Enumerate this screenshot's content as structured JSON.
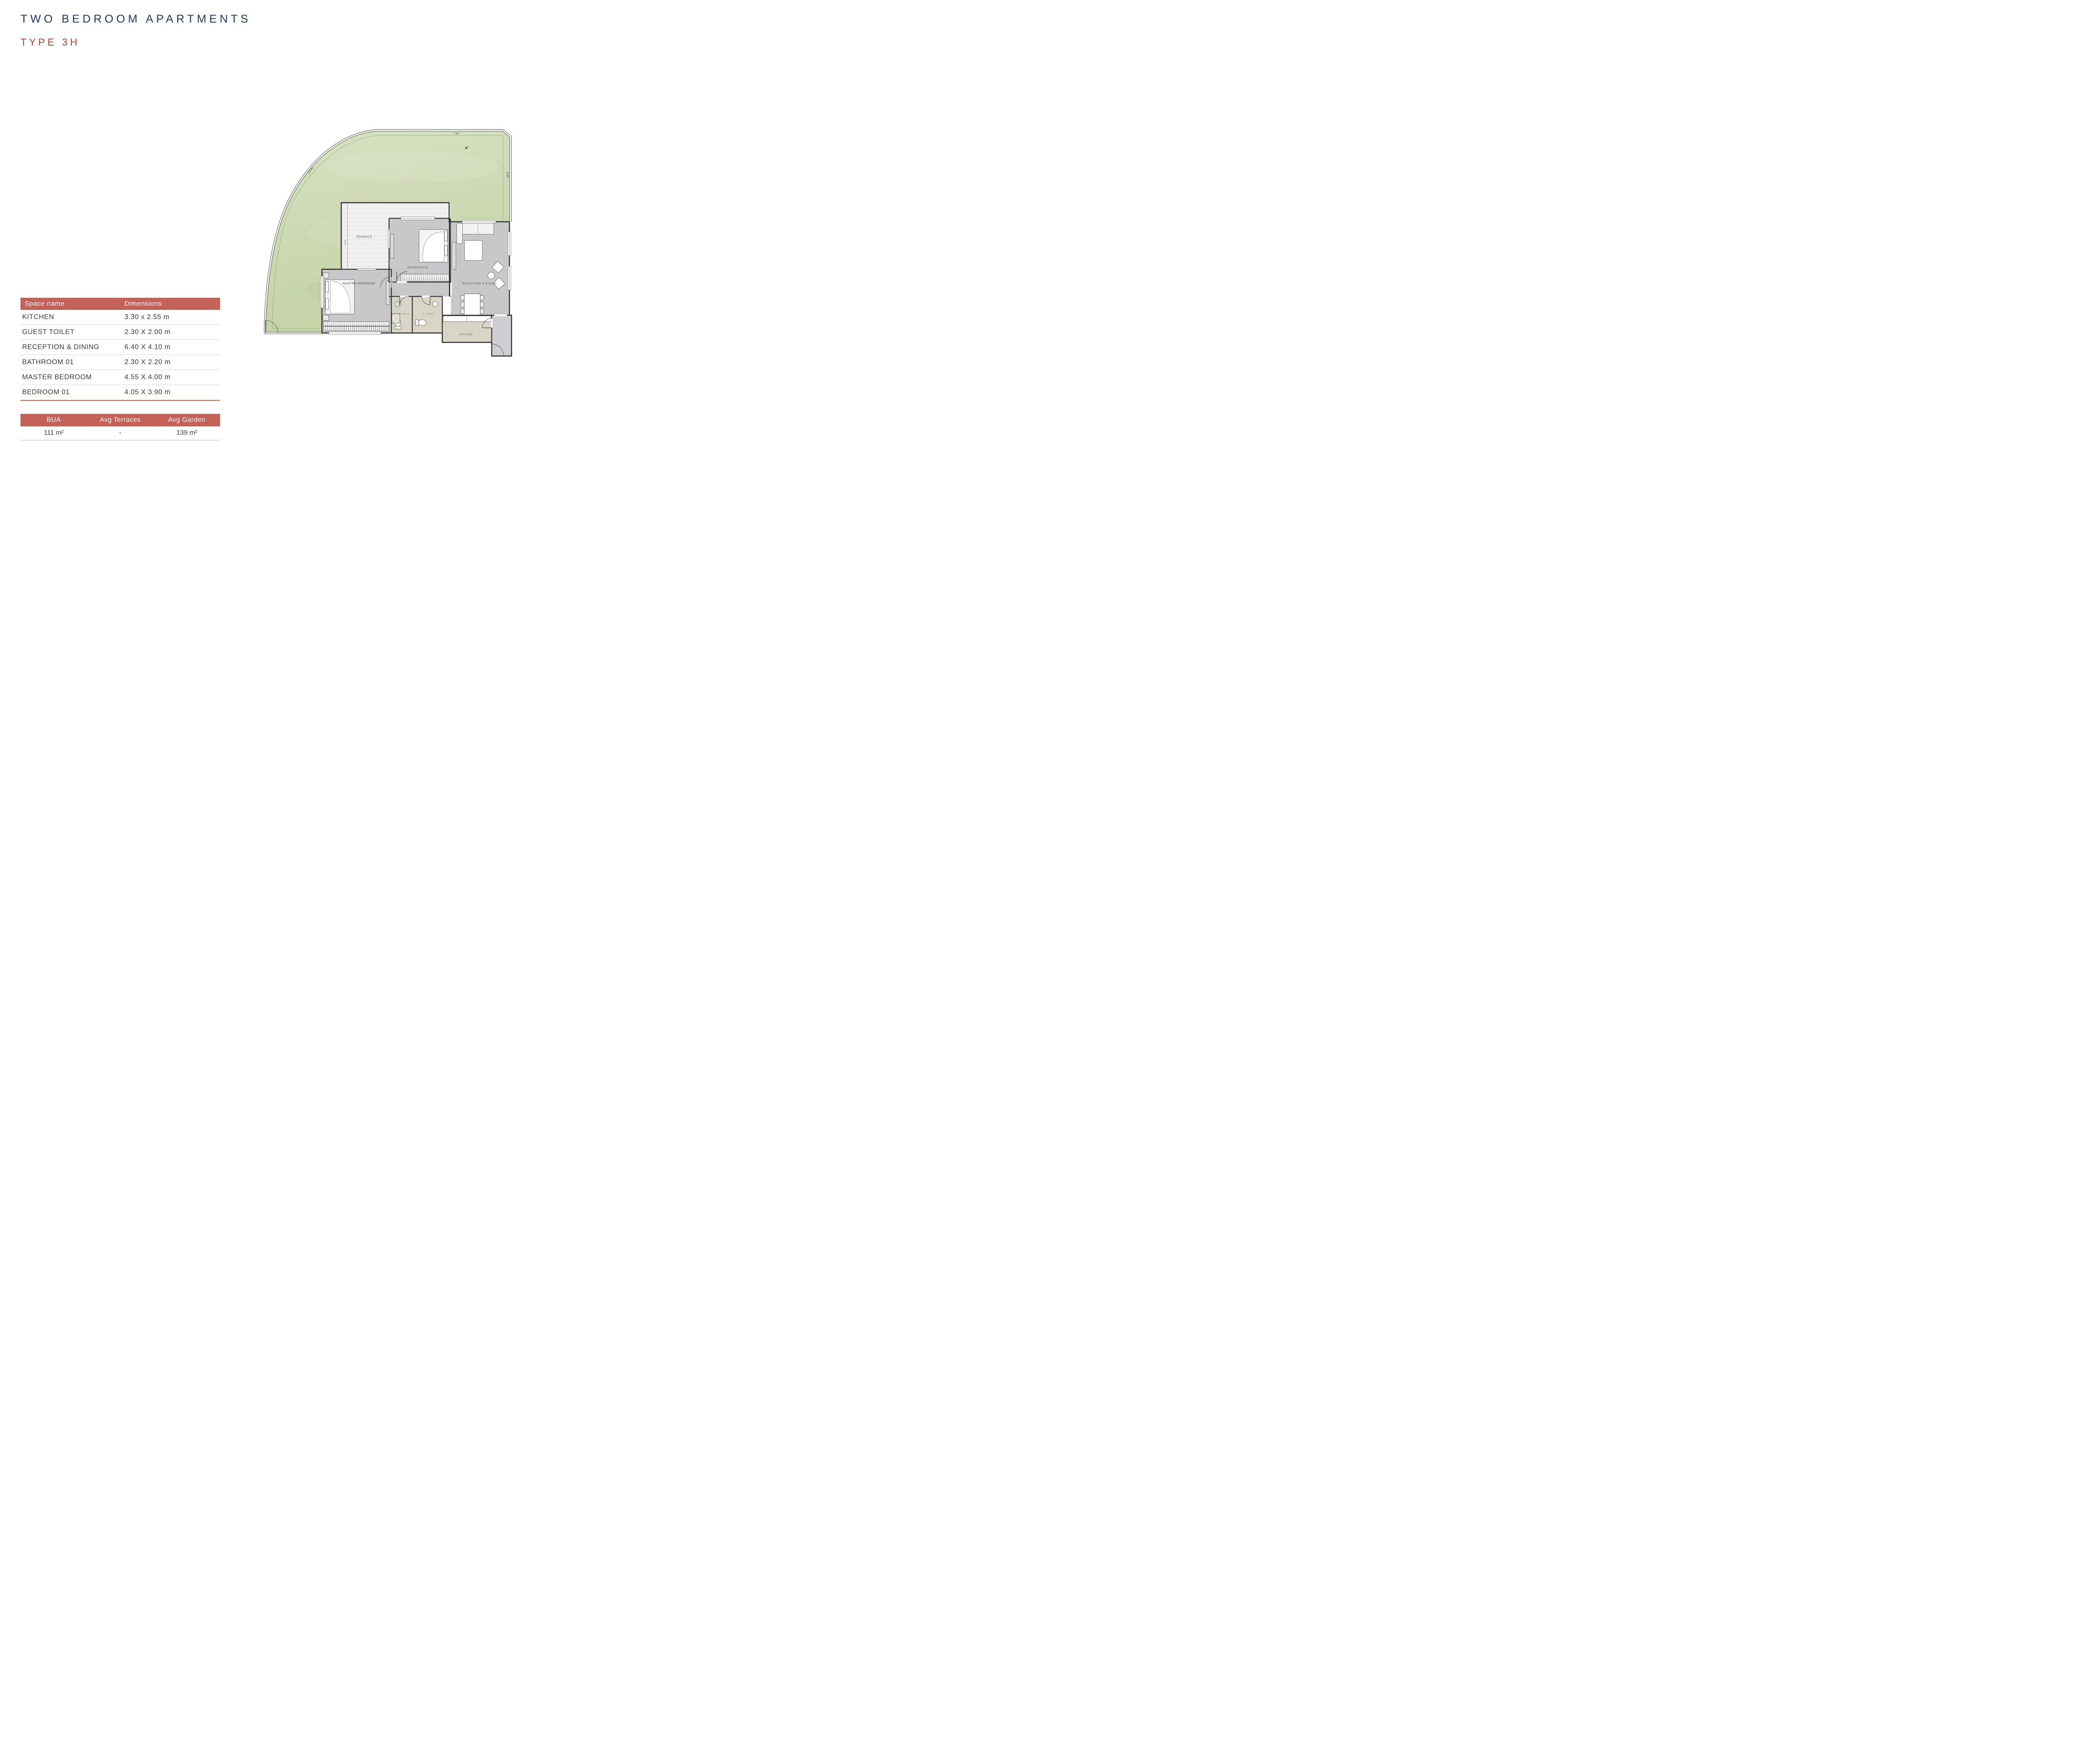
{
  "page": {
    "title": "TWO BEDROOM APARTMENTS",
    "subtitle": "TYPE 3H"
  },
  "dimensions_table": {
    "headers": [
      "Space name",
      "Dimensions"
    ],
    "rows": [
      {
        "space": "KITCHEN",
        "dimensions": "3.30 x 2.55 m"
      },
      {
        "space": "GUEST TOILET",
        "dimensions": "2.30 X 2.00 m"
      },
      {
        "space": "RECEPTION & DINING",
        "dimensions": "6.40 X 4.10 m"
      },
      {
        "space": "BATHROOM 01",
        "dimensions": "2.30 X 2.20 m"
      },
      {
        "space": "MASTER BEDROOM",
        "dimensions": "4.55 X 4.00 m"
      },
      {
        "space": "BEDROOM 01",
        "dimensions": "4.05 X 3.90 m"
      }
    ]
  },
  "summary_table": {
    "headers": [
      "BUA",
      "Avg Terraces",
      "Avg Garden"
    ],
    "values": [
      "111 m²",
      "-",
      "139 m²"
    ]
  },
  "floor_plan": {
    "rooms": {
      "terrace": "TERRACE",
      "bedroom01": "BEDROOM 01",
      "master": "MASTER BEDROOM",
      "reception": "RECEPTION & DINING",
      "bathroom": "BATHROOM 01",
      "toilet": "G. TOILET",
      "kitchen": "KITCHEN"
    },
    "dimension_labels": {
      "garden_top": "7.10",
      "garden_curve": "14.45",
      "garden_right": "8.64",
      "terrace_depth": "4.19"
    }
  },
  "colors": {
    "brand_navy": "#1d3a5f",
    "brand_red": "#b8402f",
    "table_header_bg": "#c4625a",
    "accent_underline": "#c96a50",
    "garden_green": "#ccd8b2",
    "floor_gray": "#c8c8ca",
    "floor_beige": "#d9d5c7",
    "wall": "#2d2d2d"
  }
}
